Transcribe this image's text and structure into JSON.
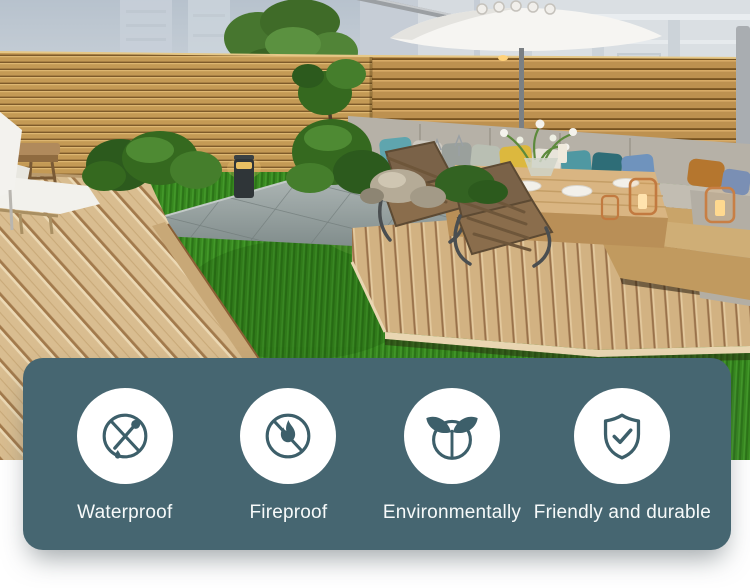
{
  "panel": {
    "background_color": "#466671",
    "icon_color": "#3D5F6A",
    "text_color": "#F7FAFA",
    "features": [
      {
        "icon": "no-water-dropper-icon",
        "label": "Waterproof"
      },
      {
        "icon": "no-fire-icon",
        "label": "Fireproof"
      },
      {
        "icon": "eco-plant-icon",
        "label": "Environmentally"
      },
      {
        "icon": "shield-check-icon",
        "label": "Friendly and durable"
      }
    ]
  },
  "scene": {
    "palette": {
      "sky": "#C3CDD6",
      "fence_wood": "#C49A55",
      "deck_wood": "#D9BD90",
      "grass": "#37881F",
      "paving": "#97A2A1"
    }
  }
}
